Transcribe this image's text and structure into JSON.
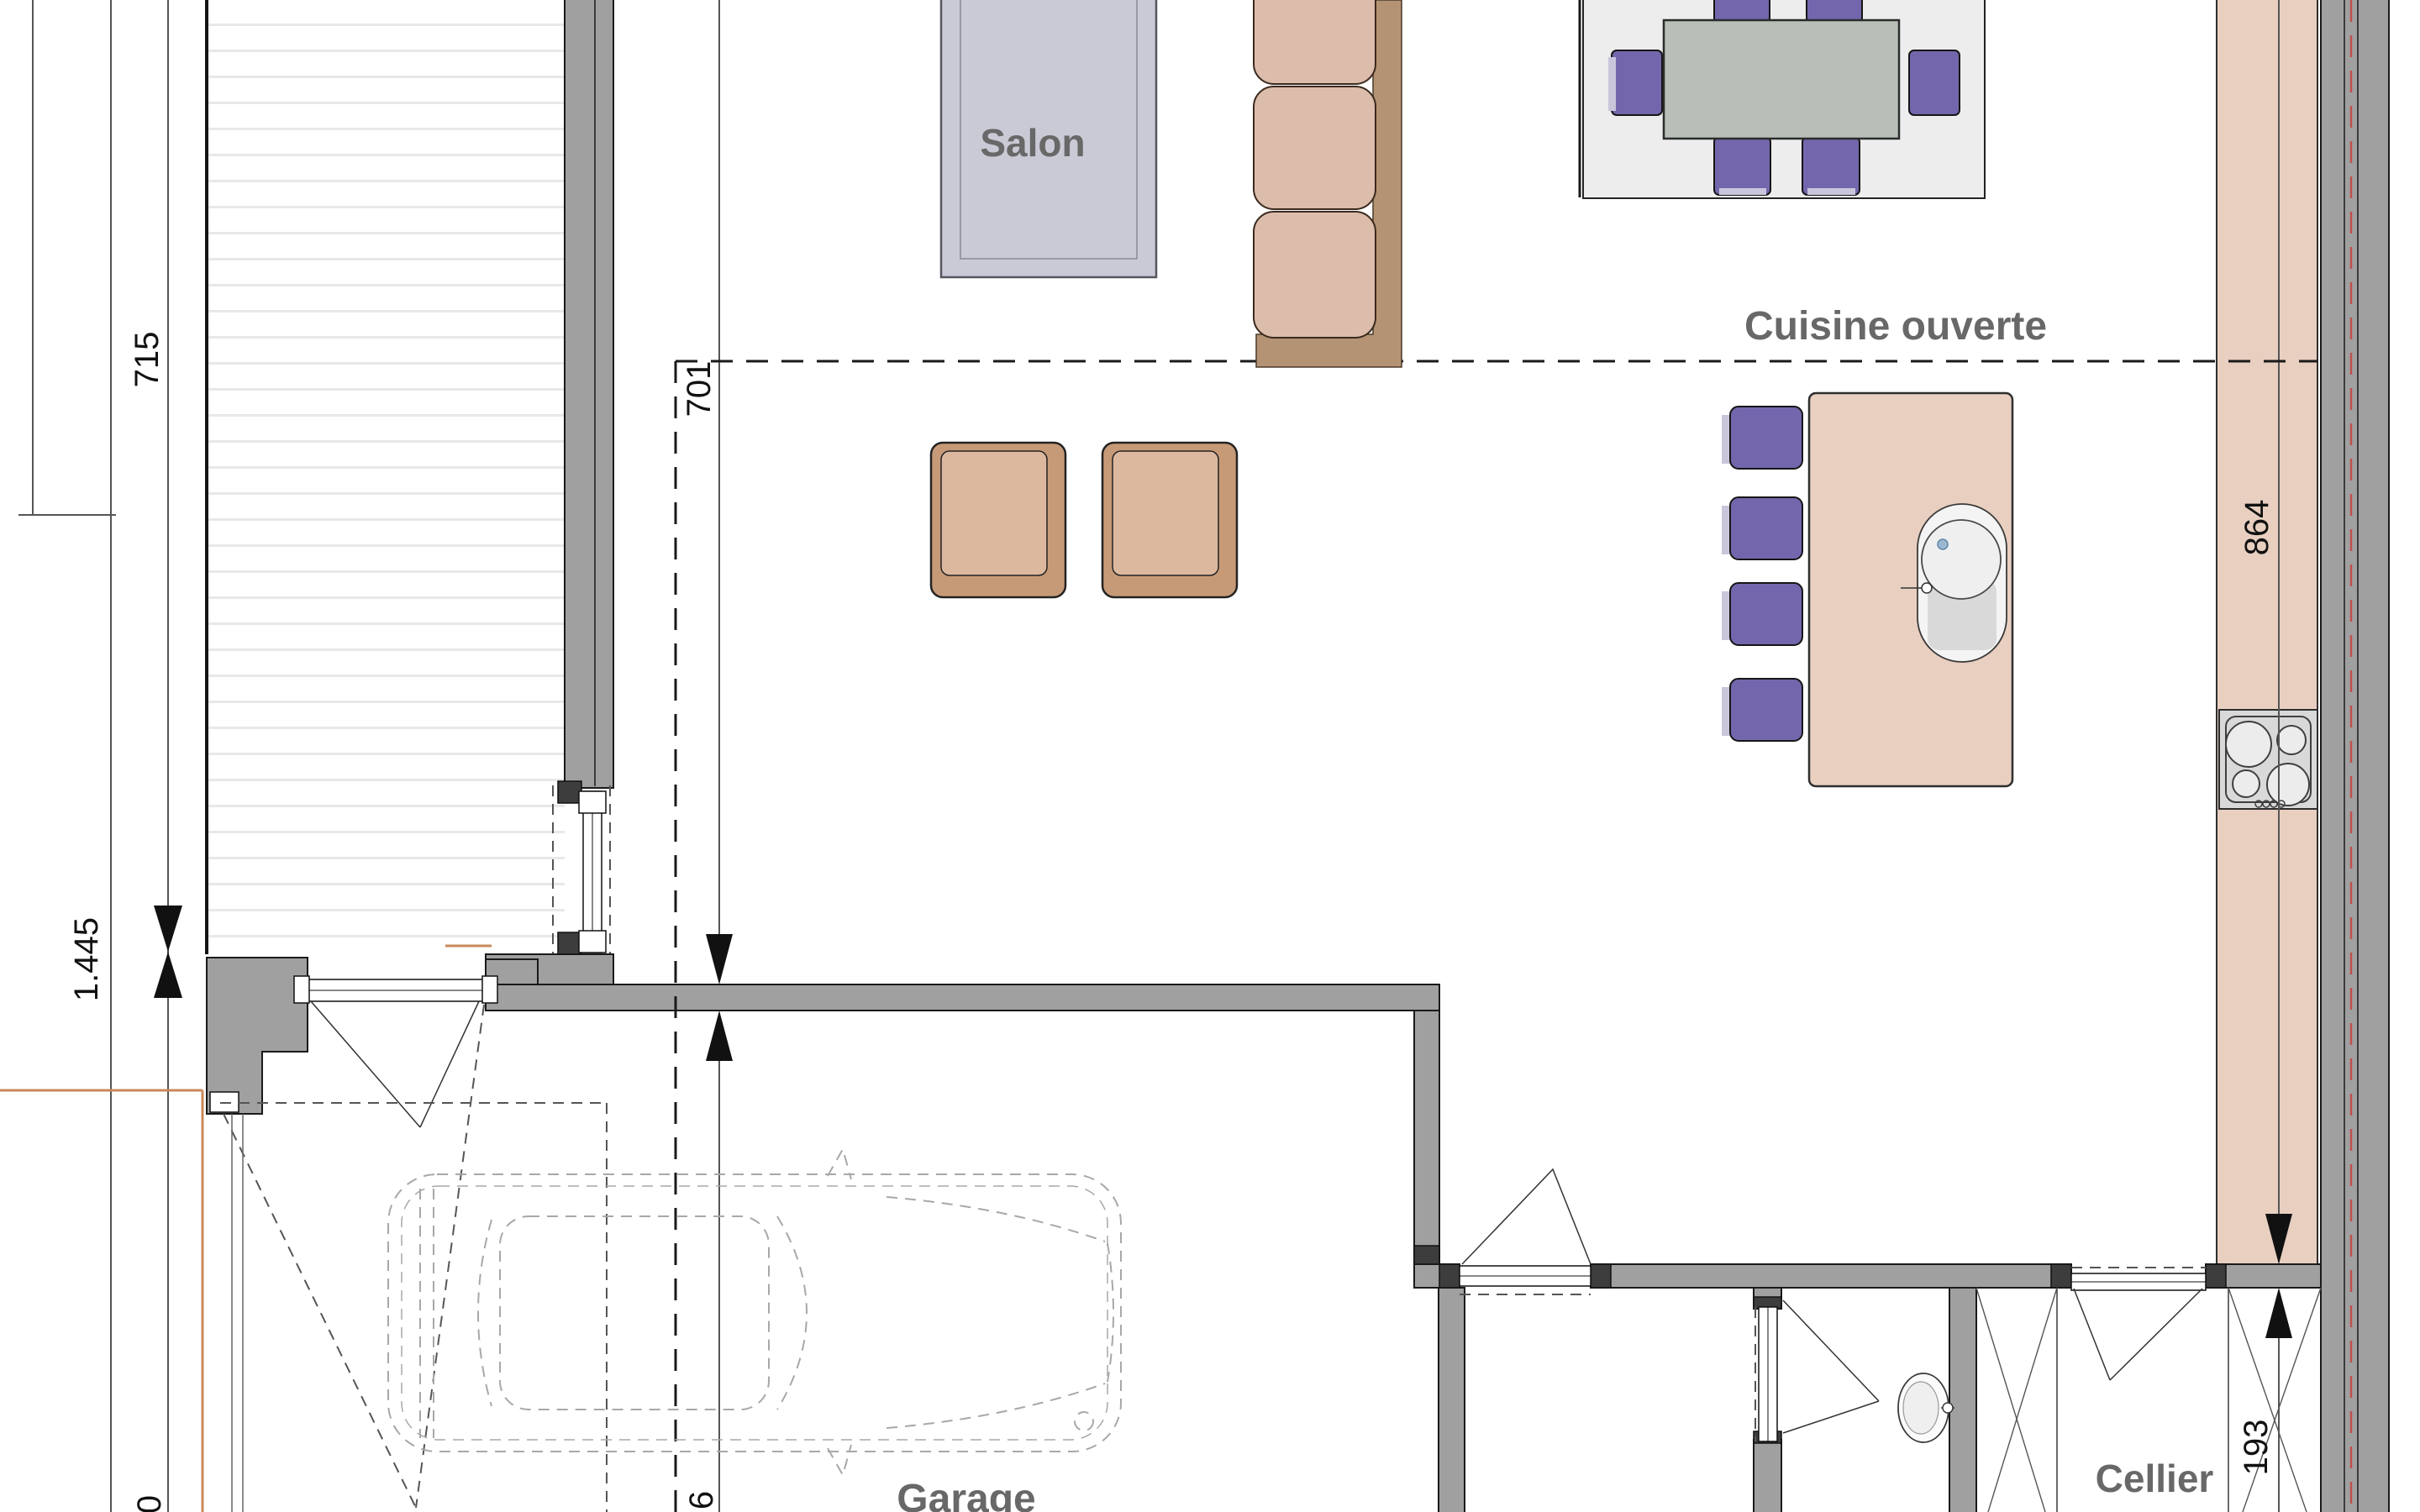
{
  "plan": {
    "rooms": {
      "salon": "Salon",
      "cuisine": "Cuisine ouverte",
      "garage": "Garage",
      "cellier": "Cellier"
    },
    "dimensions": {
      "terrace_side": "715",
      "living_side": "701",
      "setback": "1.445",
      "kitchen_run": "864",
      "cellier_width": "193",
      "cut_label_left": "0",
      "cut_label_garage": "6"
    },
    "colors": {
      "wall_gray": "#a0a0a0",
      "wall_dark": "#3d3d3d",
      "outline": "#1a1a1a",
      "cabinet_tan": "#e8cfc0",
      "sofa_cushion": "#dcbcab",
      "sofa_frame": "#b49374",
      "armchair_outer": "#c79a77",
      "armchair_seat": "#dcb99e",
      "chair_purple": "#7466ac",
      "chair_purple_light": "#c9c6dc",
      "salon_rug": "#cacad6",
      "dining_rug": "#ededed",
      "table_top": "#b7bfb8",
      "label_gray": "#686868",
      "dimension_black": "#111111",
      "insulation_red": "#c0504d",
      "exterior_tan": "#c8885a",
      "car_line": "#a8a8a8"
    }
  }
}
